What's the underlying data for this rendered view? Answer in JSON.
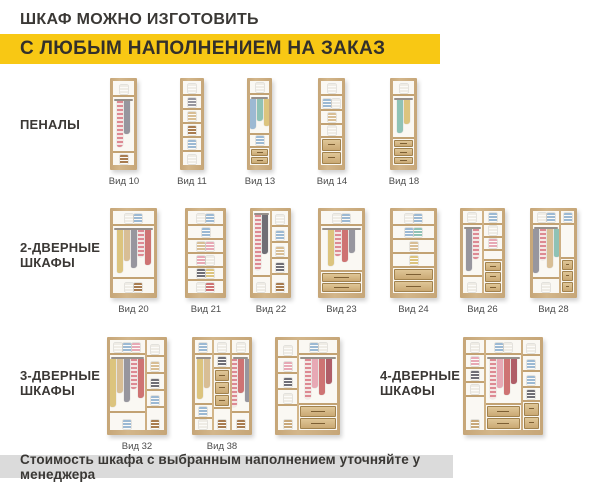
{
  "header": {
    "line1": "ШКАФ МОЖНО ИЗГОТОВИТЬ",
    "line2": "С ЛЮБЫМ НАПОЛНЕНИЕМ НА ЗАКАЗ"
  },
  "footer": {
    "text": "Стоимость шкафа с выбранным наполнением уточняйте у менеджера"
  },
  "colors": {
    "accent_yellow": "#F8C814",
    "banner_gray": "#DBDBDB",
    "text_dark": "#3A3835",
    "wood": "#C6A678",
    "wood_light": "#D3B68A",
    "wood_dark": "#A1824E",
    "label_gray": "#4B4B4B"
  },
  "item_colors": {
    "white": "#EFECE5",
    "blue": "#9CB9D3",
    "teal": "#8FC2B5",
    "yellow": "#DCC47E",
    "beige": "#D8BE95",
    "pink": "#E7A9B5",
    "pinkstripe": "#DD8A93",
    "red": "#CE7373",
    "maroon": "#B05E68",
    "gray": "#97969E",
    "dark": "#6F6E75",
    "brown": "#A87C50",
    "basket": "#C8A87B"
  },
  "row_labels": [
    {
      "id": "penaly",
      "lines": [
        "ПЕНАЛЫ"
      ],
      "x": 20,
      "y": 117
    },
    {
      "id": "2-door",
      "lines": [
        "2-ДВЕРНЫЕ",
        "ШКАФЫ"
      ],
      "x": 20,
      "y": 240
    },
    {
      "id": "3-door",
      "lines": [
        "3-ДВЕРНЫЕ",
        "ШКАФЫ"
      ],
      "x": 20,
      "y": 368
    },
    {
      "id": "4-door",
      "lines": [
        "4-ДВЕРНЫЕ",
        "ШКАФЫ"
      ],
      "x": 380,
      "y": 368
    }
  ],
  "cabinets": [
    {
      "id": "vid-10",
      "label": "Вид 10",
      "x": 110,
      "y": 78,
      "w": 27,
      "h": 92,
      "cols": [
        {
          "flex": 1,
          "cells": [
            {
              "t": "items",
              "h": 16,
              "items": [
                "white"
              ]
            },
            {
              "t": "hang",
              "h": 56,
              "clothes": [
                "pinkstripe",
                "gray"
              ]
            },
            {
              "t": "items",
              "items": [
                "brown"
              ]
            }
          ]
        }
      ]
    },
    {
      "id": "vid-11",
      "label": "Вид 11",
      "x": 180,
      "y": 78,
      "w": 24,
      "h": 92,
      "cols": [
        {
          "flex": 1,
          "cells": [
            {
              "t": "items",
              "h": 15,
              "items": [
                "white"
              ]
            },
            {
              "t": "items",
              "h": 14,
              "items": [
                "gray"
              ]
            },
            {
              "t": "items",
              "h": 14,
              "items": [
                "beige"
              ]
            },
            {
              "t": "items",
              "h": 14,
              "items": [
                "brown"
              ]
            },
            {
              "t": "items",
              "h": 14,
              "items": [
                "blue"
              ]
            },
            {
              "t": "items",
              "items": [
                "white"
              ]
            }
          ]
        }
      ]
    },
    {
      "id": "vid-13",
      "label": "Вид 13",
      "x": 247,
      "y": 78,
      "w": 25,
      "h": 92,
      "cols": [
        {
          "flex": 1,
          "cells": [
            {
              "t": "items",
              "h": 14,
              "items": [
                "white"
              ]
            },
            {
              "t": "hang",
              "h": 40,
              "clothes": [
                "blue",
                "teal",
                "yellow"
              ]
            },
            {
              "t": "items",
              "h": 13,
              "items": [
                "blue"
              ]
            },
            {
              "t": "drawers",
              "n": 2
            }
          ]
        }
      ]
    },
    {
      "id": "vid-14",
      "label": "Вид 14",
      "x": 318,
      "y": 78,
      "w": 27,
      "h": 92,
      "cols": [
        {
          "flex": 1,
          "cells": [
            {
              "t": "items",
              "h": 15,
              "items": [
                "white"
              ]
            },
            {
              "t": "items",
              "h": 15,
              "items": [
                "blue",
                "white"
              ]
            },
            {
              "t": "items",
              "h": 14,
              "items": [
                "beige"
              ]
            },
            {
              "t": "items",
              "h": 13,
              "items": [
                "white"
              ]
            },
            {
              "t": "drawers",
              "n": 2
            }
          ]
        }
      ]
    },
    {
      "id": "vid-18",
      "label": "Вид 18",
      "x": 390,
      "y": 78,
      "w": 27,
      "h": 92,
      "cols": [
        {
          "flex": 1,
          "cells": [
            {
              "t": "items",
              "h": 15,
              "items": [
                "white"
              ]
            },
            {
              "t": "hang",
              "h": 43,
              "clothes": [
                "teal",
                "yellow"
              ]
            },
            {
              "t": "drawers",
              "n": 3
            }
          ]
        }
      ]
    },
    {
      "id": "vid-20",
      "label": "Вид 20",
      "x": 110,
      "y": 208,
      "w": 47,
      "h": 90,
      "cols": [
        {
          "flex": 1,
          "cells": [
            {
              "t": "items",
              "h": 15,
              "items": [
                "white",
                "blue"
              ]
            },
            {
              "t": "hang",
              "h": 53,
              "clothes": [
                "yellow",
                "beige",
                "gray",
                "pinkstripe",
                "red"
              ]
            },
            {
              "t": "items",
              "items": [
                "white",
                "brown"
              ]
            }
          ]
        }
      ]
    },
    {
      "id": "vid-21",
      "label": "Вид 21",
      "x": 185,
      "y": 208,
      "w": 41,
      "h": 90,
      "cols": [
        {
          "flex": 1,
          "cells": [
            {
              "t": "items",
              "h": 15,
              "items": [
                "white",
                "blue"
              ]
            },
            {
              "t": "items",
              "h": 14,
              "items": [
                "blue"
              ]
            },
            {
              "t": "items",
              "h": 14,
              "items": [
                "beige",
                "pink"
              ]
            },
            {
              "t": "items",
              "h": 14,
              "items": [
                "pink",
                "white"
              ]
            },
            {
              "t": "items",
              "h": 13,
              "items": [
                "dark",
                "yellow"
              ]
            },
            {
              "t": "items",
              "items": [
                "white",
                "red"
              ]
            }
          ]
        }
      ]
    },
    {
      "id": "vid-22",
      "label": "Вид 22",
      "x": 250,
      "y": 208,
      "w": 41,
      "h": 90,
      "cols": [
        {
          "flex": 1,
          "cells": [
            {
              "t": "hang",
              "h": 66,
              "clothes": [
                "pinkstripe",
                "dark"
              ]
            },
            {
              "t": "items",
              "items": [
                "white"
              ]
            }
          ]
        },
        {
          "flex": 1,
          "cells": [
            {
              "t": "items",
              "h": 16,
              "items": [
                "white"
              ]
            },
            {
              "t": "items",
              "h": 16,
              "items": [
                "blue"
              ]
            },
            {
              "t": "items",
              "h": 16,
              "items": [
                "beige"
              ]
            },
            {
              "t": "items",
              "h": 16,
              "items": [
                "dark"
              ]
            },
            {
              "t": "items",
              "items": [
                "brown"
              ]
            }
          ]
        }
      ]
    },
    {
      "id": "vid-23",
      "label": "Вид 23",
      "x": 318,
      "y": 208,
      "w": 47,
      "h": 90,
      "cols": [
        {
          "flex": 1,
          "cells": [
            {
              "t": "items",
              "h": 15,
              "items": [
                "white",
                "blue"
              ]
            },
            {
              "t": "hang",
              "h": 46,
              "clothes": [
                "yellow",
                "pinkstripe",
                "red",
                "gray"
              ]
            },
            {
              "t": "drawers",
              "n": 2
            }
          ]
        }
      ]
    },
    {
      "id": "vid-24",
      "label": "Вид 24",
      "x": 390,
      "y": 208,
      "w": 47,
      "h": 90,
      "cols": [
        {
          "flex": 1,
          "cells": [
            {
              "t": "items",
              "h": 15,
              "items": [
                "white",
                "blue"
              ]
            },
            {
              "t": "items",
              "h": 14,
              "items": [
                "blue",
                "teal"
              ]
            },
            {
              "t": "items",
              "h": 14,
              "items": [
                "beige"
              ]
            },
            {
              "t": "items",
              "h": 14,
              "items": [
                "yellow"
              ]
            },
            {
              "t": "drawers",
              "n": 2
            }
          ]
        }
      ]
    },
    {
      "id": "vid-26",
      "label": "Вид 26",
      "x": 460,
      "y": 208,
      "w": 45,
      "h": 90,
      "cols": [
        {
          "flex": 1,
          "cells": [
            {
              "t": "items",
              "h": 14,
              "items": [
                "white"
              ]
            },
            {
              "t": "hang",
              "h": 52,
              "clothes": [
                "gray",
                "pinkstripe"
              ]
            },
            {
              "t": "items",
              "items": [
                "white"
              ]
            }
          ]
        },
        {
          "flex": 1,
          "cells": [
            {
              "t": "items",
              "h": 14,
              "items": [
                "blue"
              ]
            },
            {
              "t": "items",
              "h": 13,
              "items": [
                "white"
              ]
            },
            {
              "t": "items",
              "h": 13,
              "items": [
                "pink"
              ]
            },
            {
              "t": "empty",
              "h": 10
            },
            {
              "t": "drawers",
              "n": 3
            }
          ]
        }
      ]
    },
    {
      "id": "vid-28",
      "label": "Вид 28",
      "x": 530,
      "y": 208,
      "w": 47,
      "h": 90,
      "cols": [
        {
          "flex": 2,
          "cells": [
            {
              "t": "items",
              "h": 14,
              "items": [
                "white",
                "blue"
              ]
            },
            {
              "t": "hang",
              "h": 54,
              "clothes": [
                "gray",
                "pinkstripe",
                "beige",
                "teal"
              ]
            },
            {
              "t": "items",
              "items": [
                "white"
              ]
            }
          ]
        },
        {
          "flex": 1,
          "cells": [
            {
              "t": "items",
              "h": 14,
              "items": [
                "blue"
              ]
            },
            {
              "t": "empty",
              "h": 34
            },
            {
              "t": "drawers",
              "n": 3
            }
          ]
        }
      ]
    },
    {
      "id": "vid-32",
      "label": "Вид 32",
      "x": 107,
      "y": 337,
      "w": 60,
      "h": 98,
      "cols": [
        {
          "flex": 2,
          "cells": [
            {
              "t": "items",
              "h": 15,
              "items": [
                "white",
                "blue",
                "pink"
              ]
            },
            {
              "t": "hang",
              "h": 58,
              "clothes": [
                "yellow",
                "beige",
                "gray",
                "pinkstripe",
                "red"
              ]
            },
            {
              "t": "items",
              "items": [
                "blue"
              ]
            }
          ]
        },
        {
          "flex": 1,
          "cells": [
            {
              "t": "items",
              "h": 17,
              "items": [
                "white"
              ]
            },
            {
              "t": "items",
              "h": 17,
              "items": [
                "beige"
              ]
            },
            {
              "t": "items",
              "h": 17,
              "items": [
                "dark"
              ]
            },
            {
              "t": "items",
              "h": 17,
              "items": [
                "blue"
              ]
            },
            {
              "t": "items",
              "items": [
                "brown"
              ]
            }
          ]
        }
      ]
    },
    {
      "id": "vid-38",
      "label": "Вид 38",
      "x": 192,
      "y": 337,
      "w": 60,
      "h": 98,
      "cols": [
        {
          "flex": 1,
          "cells": [
            {
              "t": "items",
              "h": 15,
              "items": [
                "blue"
              ]
            },
            {
              "t": "hang",
              "h": 50,
              "clothes": [
                "yellow",
                "beige"
              ]
            },
            {
              "t": "items",
              "h": 14,
              "items": [
                "blue"
              ]
            },
            {
              "t": "items",
              "items": [
                "white"
              ]
            }
          ]
        },
        {
          "flex": 1,
          "cells": [
            {
              "t": "items",
              "h": 15,
              "items": [
                "white"
              ]
            },
            {
              "t": "items",
              "h": 14,
              "items": [
                "dark"
              ]
            },
            {
              "t": "drawers",
              "n": 3,
              "h": 40
            },
            {
              "t": "items",
              "items": [
                "brown"
              ]
            }
          ]
        },
        {
          "flex": 1,
          "cells": [
            {
              "t": "items",
              "h": 15,
              "items": [
                "white"
              ]
            },
            {
              "t": "hang",
              "h": 58,
              "clothes": [
                "pinkstripe",
                "red",
                "gray"
              ]
            },
            {
              "t": "items",
              "items": [
                "brown"
              ]
            }
          ]
        }
      ]
    },
    {
      "id": "three-door-with-drawers",
      "label": null,
      "x": 275,
      "y": 337,
      "w": 65,
      "h": 98,
      "cols": [
        {
          "flex": 1,
          "cells": [
            {
              "t": "items",
              "h": 18,
              "items": [
                "white"
              ]
            },
            {
              "t": "items",
              "h": 16,
              "items": [
                "pink"
              ]
            },
            {
              "t": "items",
              "h": 16,
              "items": [
                "dark"
              ]
            },
            {
              "t": "items",
              "h": 16,
              "items": [
                "white"
              ]
            },
            {
              "t": "items",
              "items": [
                "basket"
              ]
            }
          ]
        },
        {
          "flex": 2,
          "cells": [
            {
              "t": "items",
              "h": 15,
              "items": [
                "blue",
                "white"
              ]
            },
            {
              "t": "hang",
              "h": 50,
              "clothes": [
                "pinkstripe",
                "pink",
                "red",
                "maroon"
              ]
            },
            {
              "t": "drawers",
              "n": 2
            }
          ]
        }
      ]
    },
    {
      "id": "four-door",
      "label": null,
      "x": 463,
      "y": 337,
      "w": 80,
      "h": 98,
      "cols": [
        {
          "flex": 1,
          "cells": [
            {
              "t": "items",
              "h": 15,
              "items": [
                "white"
              ]
            },
            {
              "t": "items",
              "h": 14,
              "items": [
                "pink"
              ]
            },
            {
              "t": "items",
              "h": 14,
              "items": [
                "dark"
              ]
            },
            {
              "t": "items",
              "h": 14,
              "items": [
                "white"
              ]
            },
            {
              "t": "items",
              "items": [
                "basket"
              ]
            }
          ]
        },
        {
          "flex": 2,
          "cells": [
            {
              "t": "items",
              "h": 15,
              "items": [
                "blue",
                "white"
              ]
            },
            {
              "t": "hang",
              "h": 50,
              "clothes": [
                "pinkstripe",
                "pink",
                "red",
                "maroon"
              ]
            },
            {
              "t": "drawers",
              "n": 2
            }
          ]
        },
        {
          "flex": 1,
          "cells": [
            {
              "t": "items",
              "h": 16,
              "items": [
                "white"
              ]
            },
            {
              "t": "items",
              "h": 16,
              "items": [
                "blue"
              ]
            },
            {
              "t": "items",
              "h": 16,
              "items": [
                "blue"
              ]
            },
            {
              "t": "items",
              "h": 14,
              "items": [
                "dark"
              ]
            },
            {
              "t": "drawers",
              "n": 2
            }
          ]
        }
      ]
    }
  ]
}
